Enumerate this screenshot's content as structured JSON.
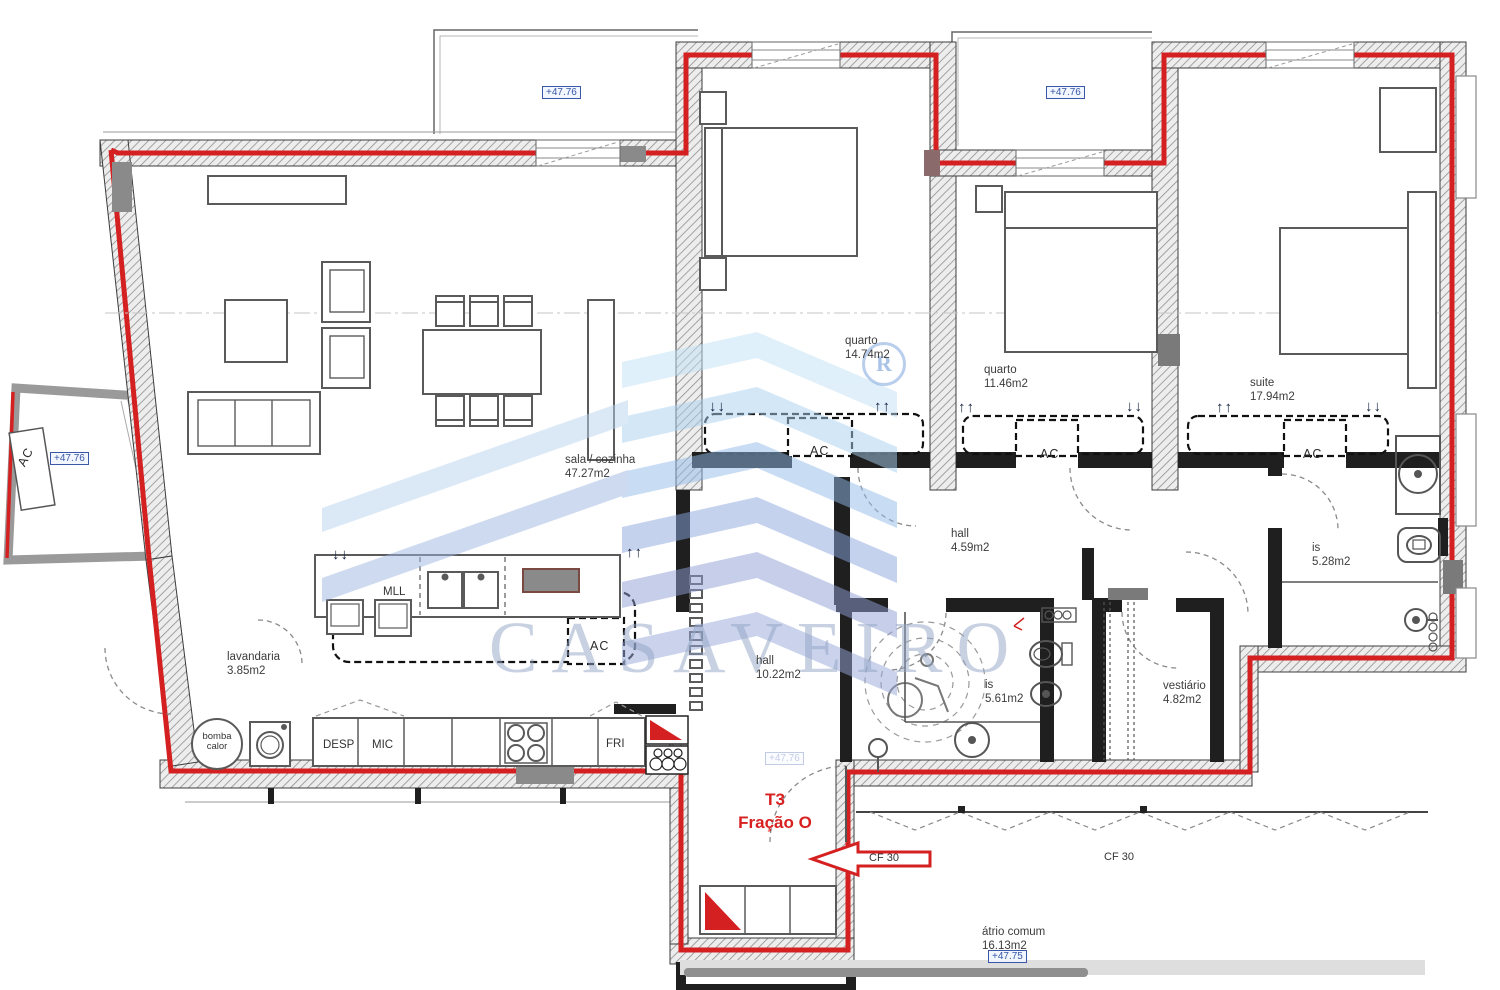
{
  "document": {
    "type": "architectural floor plan"
  },
  "watermark": {
    "brand": "CASAVEIRO",
    "registered": "R"
  },
  "unit": {
    "type": "T3",
    "fraction": "Fração O"
  },
  "fire": {
    "cf_door": "CF 30",
    "cf_hall": "CF 30"
  },
  "elevations": {
    "level": "+47.76",
    "atrium": "+47.75"
  },
  "rooms": {
    "sala": {
      "name": "sala / cozinha",
      "area": "47.27m2"
    },
    "quarto1": {
      "name": "quarto",
      "area": "14.74m2"
    },
    "quarto2": {
      "name": "quarto",
      "area": "11.46m2"
    },
    "suite": {
      "name": "suite",
      "area": "17.94m2"
    },
    "hall1": {
      "name": "hall",
      "area": "4.59m2"
    },
    "hall2": {
      "name": "hall",
      "area": "10.22m2"
    },
    "is1": {
      "name": "is",
      "area": "5.28m2"
    },
    "is2": {
      "name": "is",
      "area": "5.61m2"
    },
    "vestiario": {
      "name": "vestiário",
      "area": "4.82m2"
    },
    "lavandaria": {
      "name": "lavandaria",
      "area": "3.85m2"
    },
    "atrio": {
      "name": "átrio comum",
      "area": "16.13m2"
    }
  },
  "equipment": {
    "ac": "AC",
    "mll": "MLL",
    "desp": "DESP",
    "mic": "MIC",
    "fri": "FRI",
    "bomba_line1": "bomba",
    "bomba_line2": "calor"
  },
  "airflow": {
    "up": "↑↑",
    "down": "↓↓"
  },
  "colors": {
    "route_red": "#d42020",
    "elevation_blue": "#3a57a8",
    "watermark_blue": "#93a5c6",
    "wall_dark": "#1f1f1f"
  }
}
